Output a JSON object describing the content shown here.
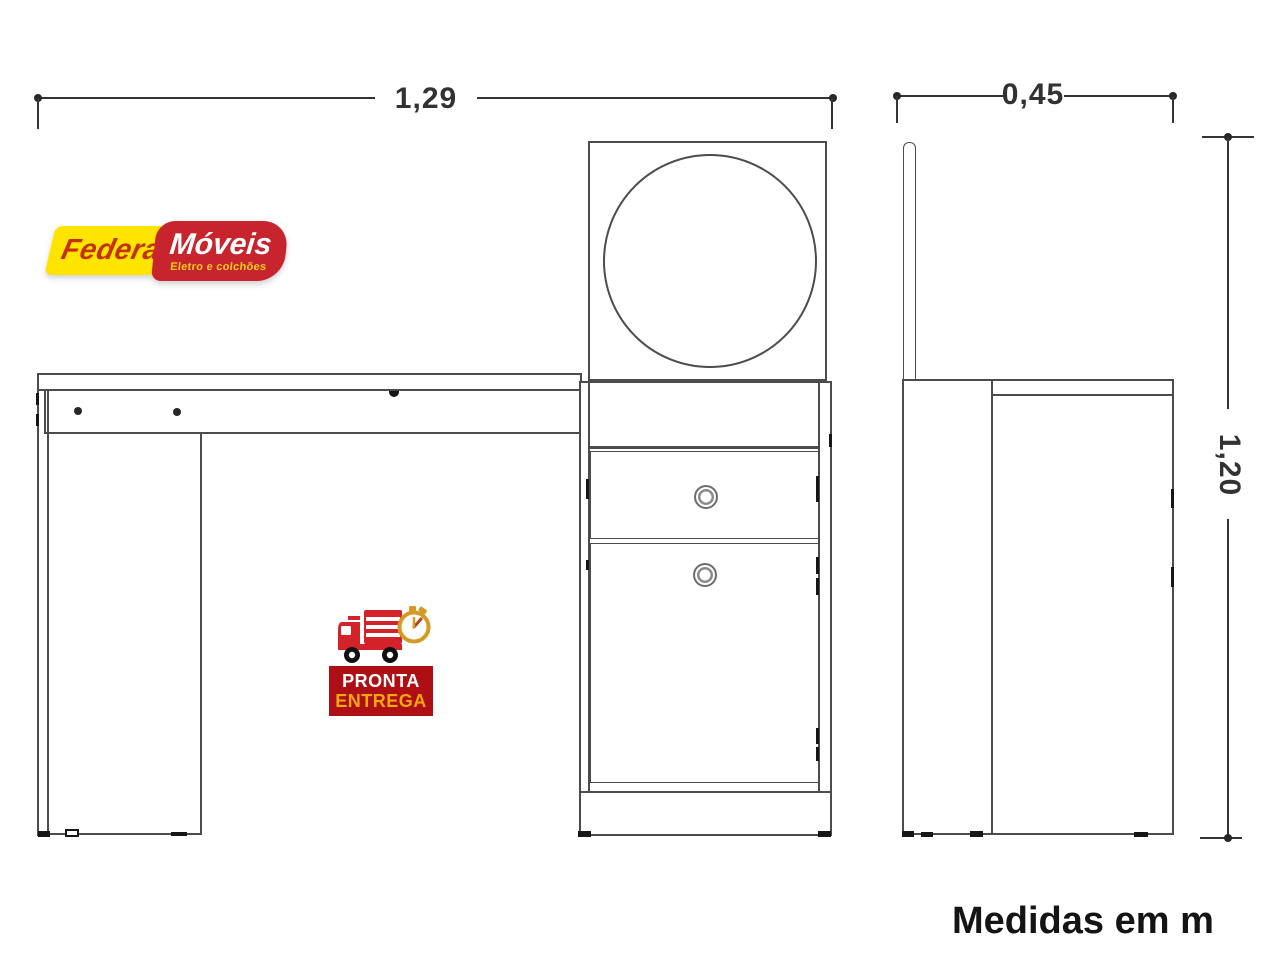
{
  "page": {
    "background": "#ffffff",
    "footnote": "Medidas em m"
  },
  "dimensions": {
    "width": "1,29",
    "depth": "0,45",
    "height": "1,20"
  },
  "drawing": {
    "type": "furniture technical drawing",
    "views": [
      "front view of dressing table with round mirror, one drawer, one door, left leg panel",
      "side view with mirror back panel"
    ],
    "line_color": "#4c4c4c",
    "dimension_color": "#343434"
  },
  "logo_federal": {
    "name": "Federal",
    "name2": "Móveis",
    "tagline": "Eletro e colchões",
    "colors": {
      "yellow": "#FFE400",
      "red": "#C8242E",
      "name_color": "#C43208",
      "name2_color": "#ffffff",
      "tagline_color": "#F8D21A"
    }
  },
  "badge_pronta": {
    "line1": "PRONTA",
    "line2": "ENTREGA",
    "colors": {
      "box": "#AD0F14",
      "line1": "#ffffff",
      "line2": "#F6A80B",
      "truck": "#D3222A",
      "stopwatch": "#D49B24"
    }
  }
}
